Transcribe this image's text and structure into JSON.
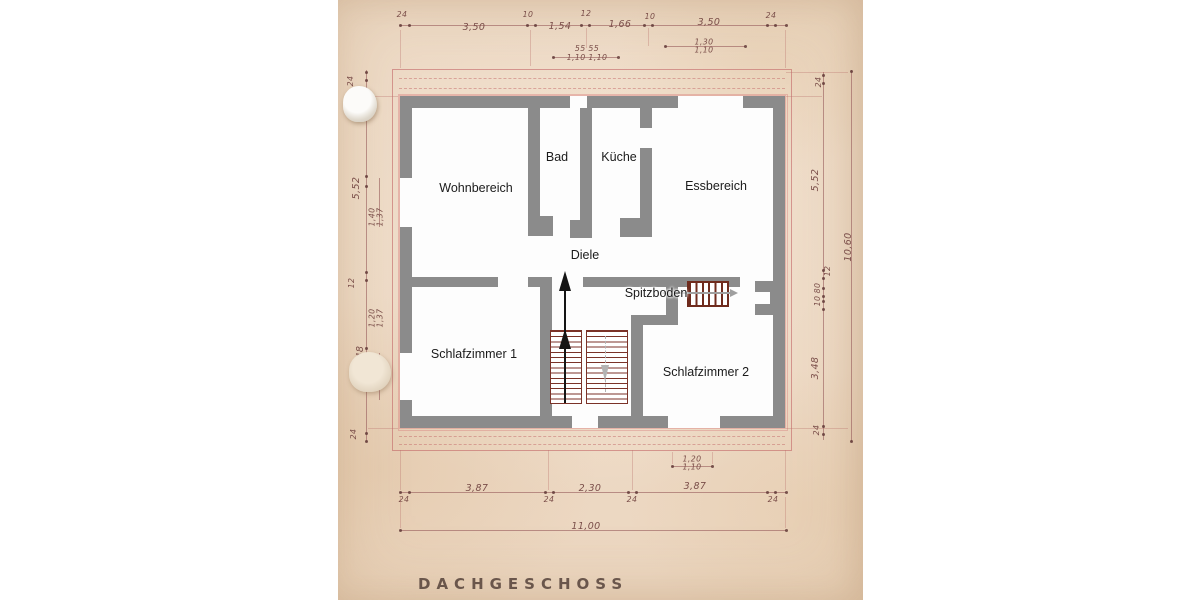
{
  "meta": {
    "title": "DACHGESCHOSS"
  },
  "colors": {
    "paper": "#eedbc7",
    "wall_gray": "#8b8b8b",
    "handwriting_ink": "#7a4e49",
    "blueprint_red": "#c46a6e",
    "stair_tread": "#7b3228",
    "up_arrow": "#151515",
    "hatch_arrow": "#9f9f9f",
    "room_label": "#1b1b1b"
  },
  "rooms": [
    {
      "id": "wohnbereich",
      "label": "Wohnbereich",
      "x": 476,
      "y": 188
    },
    {
      "id": "bad",
      "label": "Bad",
      "x": 557,
      "y": 157
    },
    {
      "id": "kueche",
      "label": "Küche",
      "x": 619,
      "y": 157
    },
    {
      "id": "essbereich",
      "label": "Essbereich",
      "x": 716,
      "y": 186
    },
    {
      "id": "diele",
      "label": "Diele",
      "x": 585,
      "y": 255
    },
    {
      "id": "spitzboden",
      "label": "Spitzboden",
      "x": 656,
      "y": 293
    },
    {
      "id": "schlafzimmer-1",
      "label": "Schlafzimmer 1",
      "x": 474,
      "y": 354
    },
    {
      "id": "schlafzimmer-2",
      "label": "Schlafzimmer 2",
      "x": 706,
      "y": 372
    }
  ],
  "dimensions": {
    "top": [
      "24",
      "3,50",
      "10",
      "1,54",
      "12",
      "1,66",
      "10",
      "3,50",
      "24"
    ],
    "top_sub": [
      "55   55",
      "1,10  1,10",
      "1,30 / 1,10"
    ],
    "left": [
      "24",
      "5,52",
      "1,40 / 1,37",
      "12",
      "1,20 / 1,37",
      "3,48",
      "24"
    ],
    "right": [
      "24",
      "5,52",
      "12",
      "80",
      "10",
      "3,48",
      "24",
      "10,60"
    ],
    "bottom": [
      "24",
      "3,87",
      "24",
      "2,30",
      "24",
      "3,87",
      "24",
      "11,00",
      "1,20 / 1,10"
    ]
  },
  "dim_labels": [
    {
      "t": "24",
      "x": 402,
      "y": 15,
      "sm": 1
    },
    {
      "t": "3,50",
      "x": 474,
      "y": 28
    },
    {
      "t": "10",
      "x": 528,
      "y": 15,
      "sm": 1
    },
    {
      "t": "1,54",
      "x": 560,
      "y": 27
    },
    {
      "t": "12",
      "x": 586,
      "y": 14,
      "sm": 1
    },
    {
      "t": "1,66",
      "x": 620,
      "y": 25
    },
    {
      "t": "10",
      "x": 650,
      "y": 17,
      "sm": 1
    },
    {
      "t": "3,50",
      "x": 709,
      "y": 23
    },
    {
      "t": "24",
      "x": 771,
      "y": 16,
      "sm": 1
    },
    {
      "t": "55   55",
      "x": 587,
      "y": 49,
      "sm": 1
    },
    {
      "t": "1,10  1,10",
      "x": 587,
      "y": 58,
      "sm": 1
    },
    {
      "t": "1,30\n1,10",
      "x": 704,
      "y": 47,
      "sm": 1
    },
    {
      "t": "24",
      "x": 351,
      "y": 81,
      "sm": 1,
      "r": 1
    },
    {
      "t": "5,52",
      "x": 357,
      "y": 188,
      "r": 1
    },
    {
      "t": "1,40\n1,37",
      "x": 377,
      "y": 217,
      "sm": 1,
      "r": 1
    },
    {
      "t": "12",
      "x": 352,
      "y": 283,
      "sm": 1,
      "r": 1
    },
    {
      "t": "1,20\n1,37",
      "x": 377,
      "y": 318,
      "sm": 1,
      "r": 1
    },
    {
      "t": "3,48",
      "x": 361,
      "y": 357,
      "r": 1
    },
    {
      "t": "24",
      "x": 354,
      "y": 434,
      "sm": 1,
      "r": 1
    },
    {
      "t": "24",
      "x": 819,
      "y": 82,
      "sm": 1,
      "r": 1
    },
    {
      "t": "5,52",
      "x": 816,
      "y": 180,
      "r": 1
    },
    {
      "t": "12",
      "x": 828,
      "y": 271,
      "sm": 1,
      "r": 1
    },
    {
      "t": "80",
      "x": 818,
      "y": 288,
      "sm": 1,
      "r": 1
    },
    {
      "t": "10",
      "x": 818,
      "y": 301,
      "sm": 1,
      "r": 1
    },
    {
      "t": "3,48",
      "x": 816,
      "y": 368,
      "r": 1
    },
    {
      "t": "24",
      "x": 817,
      "y": 430,
      "sm": 1,
      "r": 1
    },
    {
      "t": "10,60",
      "x": 849,
      "y": 247,
      "r": 1
    },
    {
      "t": "1,20\n1,10",
      "x": 692,
      "y": 464,
      "sm": 1
    },
    {
      "t": "24",
      "x": 404,
      "y": 500,
      "sm": 1
    },
    {
      "t": "3,87",
      "x": 477,
      "y": 489
    },
    {
      "t": "24",
      "x": 549,
      "y": 500,
      "sm": 1
    },
    {
      "t": "2,30",
      "x": 590,
      "y": 489
    },
    {
      "t": "24",
      "x": 632,
      "y": 500,
      "sm": 1
    },
    {
      "t": "3,87",
      "x": 695,
      "y": 487
    },
    {
      "t": "24",
      "x": 773,
      "y": 500,
      "sm": 1
    },
    {
      "t": "11,00",
      "x": 586,
      "y": 527
    }
  ]
}
